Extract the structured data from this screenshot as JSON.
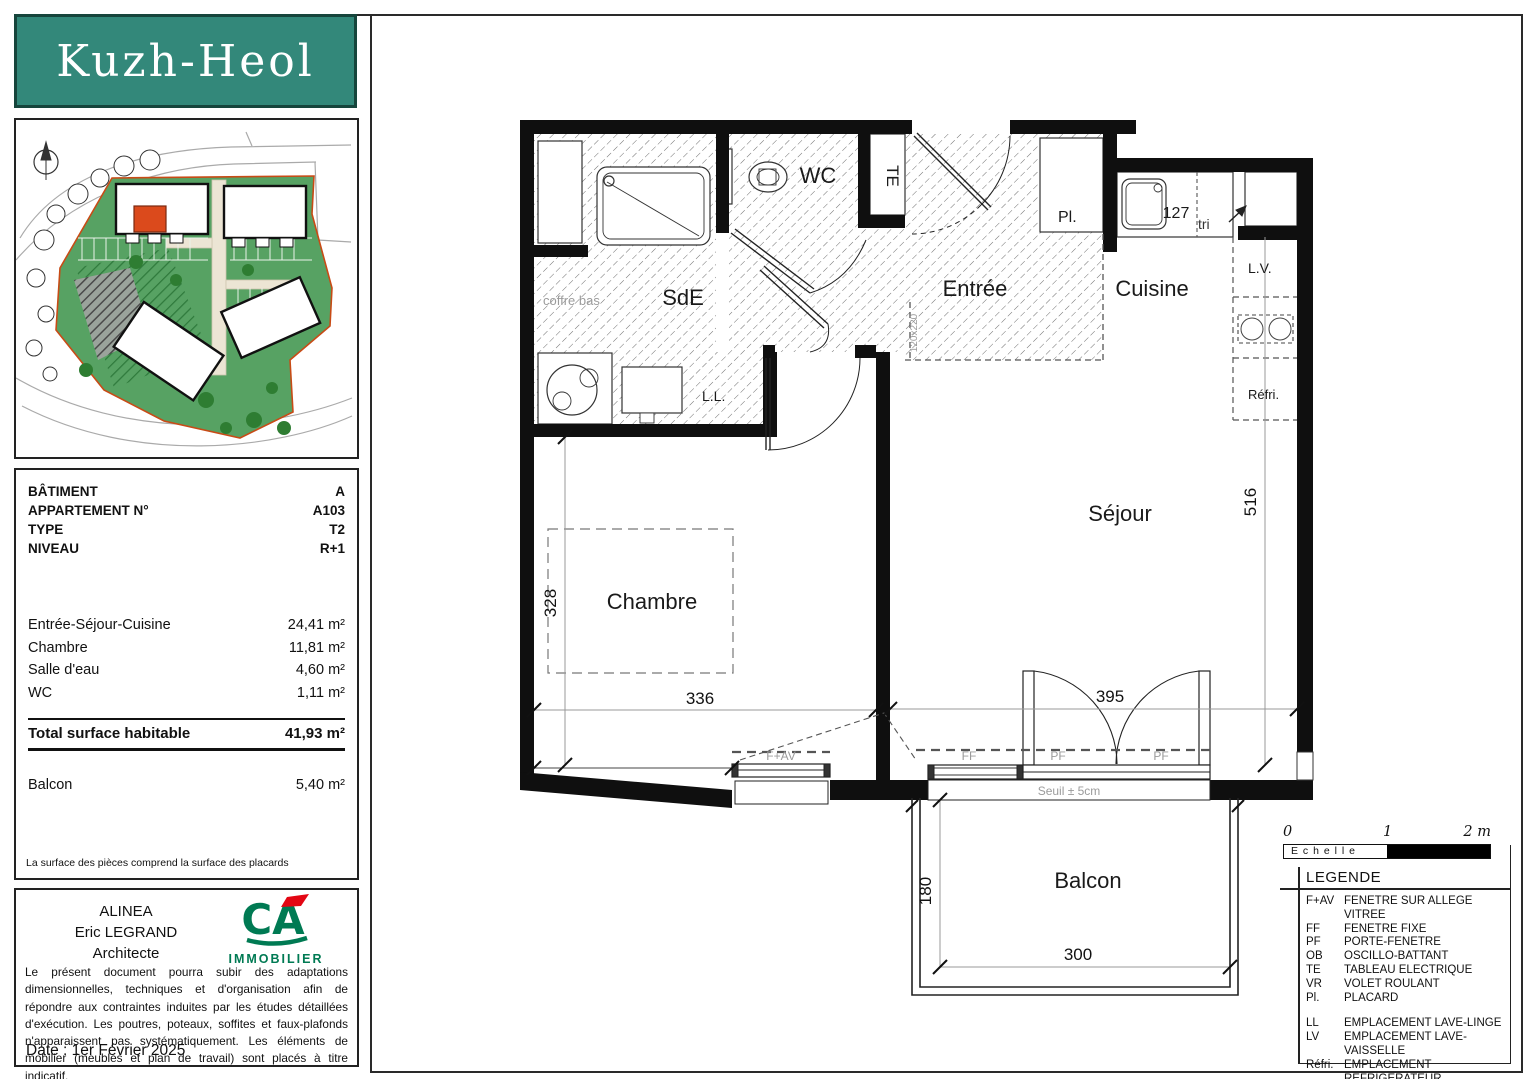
{
  "logo": {
    "title": "Kuzh-Heol"
  },
  "info": {
    "rows": [
      {
        "label": "BÂTIMENT",
        "value": "A"
      },
      {
        "label": "APPARTEMENT N°",
        "value": "A103"
      },
      {
        "label": "TYPE",
        "value": "T2"
      },
      {
        "label": "NIVEAU",
        "value": "R+1"
      }
    ],
    "areas": [
      {
        "label": "Entrée-Séjour-Cuisine",
        "value": "24,41  m²"
      },
      {
        "label": "Chambre",
        "value": "11,81  m²"
      },
      {
        "label": "Salle d'eau",
        "value": "4,60  m²"
      },
      {
        "label": "WC",
        "value": "1,11  m²"
      }
    ],
    "total": {
      "label": "Total surface habitable",
      "value": "41,93  m²"
    },
    "balcony": {
      "label": "Balcon",
      "value": "5,40  m²"
    },
    "footnote": "La surface des pièces comprend la surface des placards"
  },
  "architect": {
    "company": "ALINEA",
    "name": "Eric LEGRAND",
    "role": "Architecte",
    "brand_initials": "CA",
    "brand": "IMMOBILIER",
    "disclaimer": "Le présent document pourra subir des adaptations dimensionnelles, techniques et d'organisation afin de répondre aux contraintes induites par les études détaillées d'exécution. Les poutres, poteaux, soffites et faux-plafonds n'apparaissent pas systématiquement. Les éléments de mobilier (meubles et plan de travail) sont placés à titre indicatif.",
    "date": "Date : 1er Février 2025"
  },
  "plan": {
    "rooms": {
      "sde": "SdE",
      "wc": "WC",
      "entree": "Entrée",
      "cuisine": "Cuisine",
      "sejour": "Séjour",
      "chambre": "Chambre",
      "balcon": "Balcon"
    },
    "labels": {
      "te": "TE",
      "pl": "Pl.",
      "tri": "tri",
      "lv": "L.V.",
      "refri": "Réfri.",
      "ll": "L.L.",
      "coffre_bas": "coffre bas",
      "door_size": "120x220",
      "seuil": "Seuil ± 5cm",
      "f_av": "F+AV",
      "ff": "FF",
      "pf1": "PF",
      "pf2": "PF"
    },
    "dims": {
      "d127": "127",
      "d516": "516",
      "d395": "395",
      "d336": "336",
      "d328": "328",
      "d180": "180",
      "d300": "300"
    }
  },
  "scale": {
    "t0": "0",
    "t1": "1",
    "t2": "2 m",
    "label": "E c h e l l e"
  },
  "legend": {
    "title": "LEGENDE",
    "items": [
      {
        "abbr": "F+AV",
        "desc": "FENETRE SUR ALLEGE VITREE"
      },
      {
        "abbr": "FF",
        "desc": "FENETRE FIXE"
      },
      {
        "abbr": "PF",
        "desc": "PORTE-FENETRE"
      },
      {
        "abbr": "OB",
        "desc": "OSCILLO-BATTANT"
      },
      {
        "abbr": "TE",
        "desc": "TABLEAU ELECTRIQUE"
      },
      {
        "abbr": "VR",
        "desc": "VOLET ROULANT"
      },
      {
        "abbr": "Pl.",
        "desc": "PLACARD"
      }
    ],
    "items2": [
      {
        "abbr": "LL",
        "desc": "EMPLACEMENT LAVE-LINGE"
      },
      {
        "abbr": "LV",
        "desc": "EMPLACEMENT LAVE-VAISSELLE"
      },
      {
        "abbr": "Réfri.",
        "desc": "EMPLACEMENT REFRIGERATEUR"
      },
      {
        "abbr": "",
        "desc": "FAUX-PLAFOND OU SOFFITE"
      }
    ]
  },
  "colors": {
    "logo_bg": "#33887a",
    "site_green": "#57a263",
    "site_boundary": "#c84b16",
    "unit_red": "#db4a1c",
    "ca_green": "#007a53",
    "ca_red": "#e30613",
    "gray_label": "#9b9b9b"
  }
}
